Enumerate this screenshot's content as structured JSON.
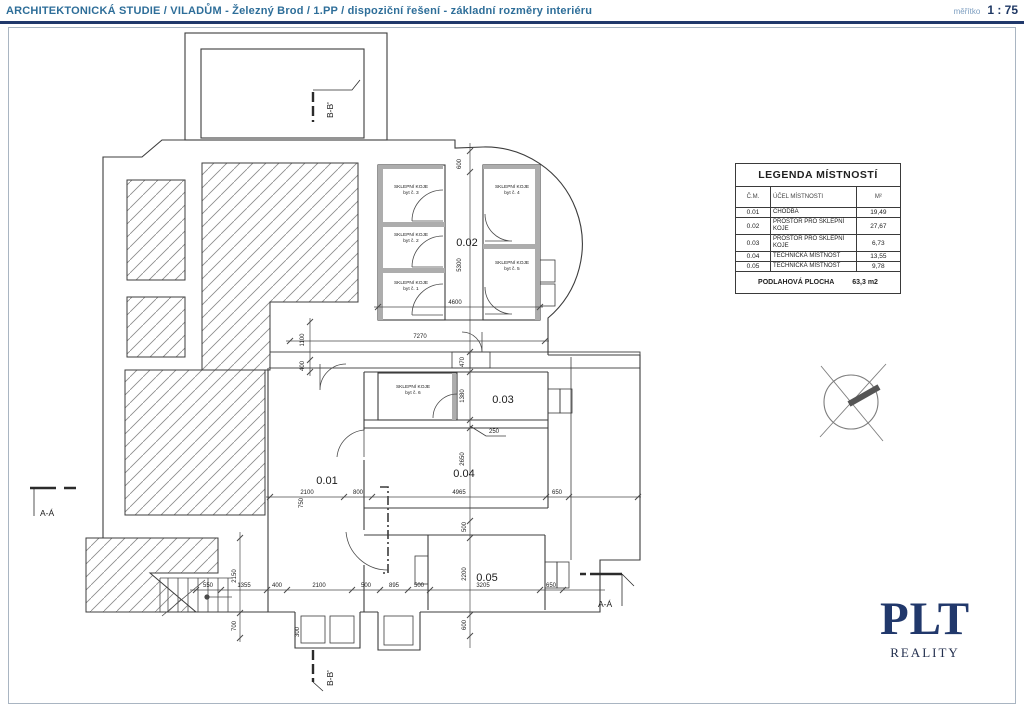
{
  "header": {
    "title": "ARCHITEKTONICKÁ STUDIE / VILADŮM - Železný Brod / 1.PP / dispoziční řešení - základní rozměry interiéru",
    "scale_label": "měřítko",
    "scale_value": "1 : 75"
  },
  "legend": {
    "title": "LEGENDA MÍSTNOSTÍ",
    "columns": [
      "Č.M.",
      "ÚČEL MÍSTNOSTI",
      "M²"
    ],
    "rows": [
      {
        "num": "0.01",
        "use": "CHODBA",
        "area": "19,49"
      },
      {
        "num": "0.02",
        "use": "PROSTOR PRO SKLEPNÍ KOJE",
        "area": "27,67"
      },
      {
        "num": "0.03",
        "use": "PROSTOR PRO SKLEPNÍ KOJE",
        "area": "6,73"
      },
      {
        "num": "0.04",
        "use": "TECHNICKÁ MÍSTNOST",
        "area": "13,55"
      },
      {
        "num": "0.05",
        "use": "TECHNICKÁ MÍSTNOST",
        "area": "9,78"
      }
    ],
    "footer_label": "PODLAHOVÁ PLOCHA",
    "footer_value": "63,3 m2"
  },
  "rooms": [
    {
      "id": "0.01",
      "x": 327,
      "y": 484
    },
    {
      "id": "0.02",
      "x": 467,
      "y": 246
    },
    {
      "id": "0.03",
      "x": 503,
      "y": 403
    },
    {
      "id": "0.04",
      "x": 464,
      "y": 477
    },
    {
      "id": "0.05",
      "x": 487,
      "y": 581
    }
  ],
  "koje_labels": [
    {
      "l1": "SKLEPNÍ KOJE",
      "l2": "byt č. 3",
      "x": 411,
      "y": 188
    },
    {
      "l1": "SKLEPNÍ KOJE",
      "l2": "byt č. 2",
      "x": 411,
      "y": 236
    },
    {
      "l1": "SKLEPNÍ KOJE",
      "l2": "byt č. 1",
      "x": 411,
      "y": 284
    },
    {
      "l1": "SKLEPNÍ KOJE",
      "l2": "byt č. 4",
      "x": 512,
      "y": 188
    },
    {
      "l1": "SKLEPNÍ KOJE",
      "l2": "byt č. 5",
      "x": 512,
      "y": 264
    },
    {
      "l1": "SKLEPNÍ KOJE",
      "l2": "byt č. 6",
      "x": 413,
      "y": 388
    }
  ],
  "section_markers": {
    "a_left": "A-Á",
    "a_right": "A-Á",
    "b_top": "B-B'",
    "b_bottom": "B-B'"
  },
  "dim_chains": [
    {
      "o": "v",
      "pos": 470,
      "from": 143,
      "to": 648,
      "ticks": [
        151,
        172,
        352,
        372,
        420,
        428,
        521,
        538,
        615,
        636
      ]
    },
    {
      "o": "h",
      "pos": 307,
      "from": 374,
      "to": 543,
      "ticks": [
        378,
        540
      ]
    },
    {
      "o": "h",
      "pos": 341,
      "from": 286,
      "to": 549,
      "ticks": [
        290,
        545
      ]
    },
    {
      "o": "v",
      "pos": 310,
      "from": 318,
      "to": 376,
      "ticks": [
        322,
        360,
        372
      ]
    },
    {
      "o": "h",
      "pos": 497,
      "from": 266,
      "to": 641,
      "ticks": [
        270,
        344,
        372,
        546,
        569,
        638
      ]
    },
    {
      "o": "v",
      "pos": 240,
      "from": 532,
      "to": 642,
      "ticks": [
        538,
        613,
        638
      ]
    },
    {
      "o": "h",
      "pos": 590,
      "from": 190,
      "to": 605,
      "ticks": [
        196,
        221,
        267,
        287,
        352,
        380,
        408,
        430,
        540,
        563
      ]
    }
  ],
  "dim_labels": [
    {
      "t": "600",
      "x": 461,
      "y": 164,
      "r": 1
    },
    {
      "t": "5300",
      "x": 461,
      "y": 265,
      "r": 1
    },
    {
      "t": "4600",
      "x": 455,
      "y": 304,
      "r": 0
    },
    {
      "t": "7270",
      "x": 420,
      "y": 338,
      "r": 0
    },
    {
      "t": "1100",
      "x": 304,
      "y": 340,
      "r": 1
    },
    {
      "t": "400",
      "x": 304,
      "y": 366,
      "r": 1
    },
    {
      "t": "470",
      "x": 464,
      "y": 362,
      "r": 1
    },
    {
      "t": "1380",
      "x": 464,
      "y": 396,
      "r": 1
    },
    {
      "t": "250",
      "x": 494,
      "y": 433,
      "r": 0
    },
    {
      "t": "2650",
      "x": 464,
      "y": 459,
      "r": 1
    },
    {
      "t": "750",
      "x": 303,
      "y": 503,
      "r": 1
    },
    {
      "t": "2100",
      "x": 307,
      "y": 494,
      "r": 0
    },
    {
      "t": "800",
      "x": 358,
      "y": 494,
      "r": 0
    },
    {
      "t": "4965",
      "x": 459,
      "y": 494,
      "r": 0
    },
    {
      "t": "650",
      "x": 557,
      "y": 494,
      "r": 0
    },
    {
      "t": "500",
      "x": 466,
      "y": 527,
      "r": 1
    },
    {
      "t": "2200",
      "x": 466,
      "y": 574,
      "r": 1
    },
    {
      "t": "600",
      "x": 466,
      "y": 625,
      "r": 1
    },
    {
      "t": "2150",
      "x": 236,
      "y": 576,
      "r": 1
    },
    {
      "t": "700",
      "x": 236,
      "y": 626,
      "r": 1
    },
    {
      "t": "550",
      "x": 208,
      "y": 587,
      "r": 0
    },
    {
      "t": "1355",
      "x": 244,
      "y": 587,
      "r": 0
    },
    {
      "t": "400",
      "x": 277,
      "y": 587,
      "r": 0
    },
    {
      "t": "2100",
      "x": 319,
      "y": 587,
      "r": 0
    },
    {
      "t": "500",
      "x": 366,
      "y": 587,
      "r": 0
    },
    {
      "t": "895",
      "x": 394,
      "y": 587,
      "r": 0
    },
    {
      "t": "500",
      "x": 419,
      "y": 587,
      "r": 0
    },
    {
      "t": "3205",
      "x": 483,
      "y": 587,
      "r": 0
    },
    {
      "t": "650",
      "x": 551,
      "y": 587,
      "r": 0
    },
    {
      "t": "300",
      "x": 299,
      "y": 632,
      "r": 1
    }
  ],
  "logo": {
    "name": "PLT",
    "subtitle": "REALITY"
  },
  "colors": {
    "title_text": "#2e6e99",
    "divider": "#20386b",
    "drawing_line": "#3c3c3c",
    "wall_fill": "#adadad",
    "logo_navy": "#21386b"
  }
}
